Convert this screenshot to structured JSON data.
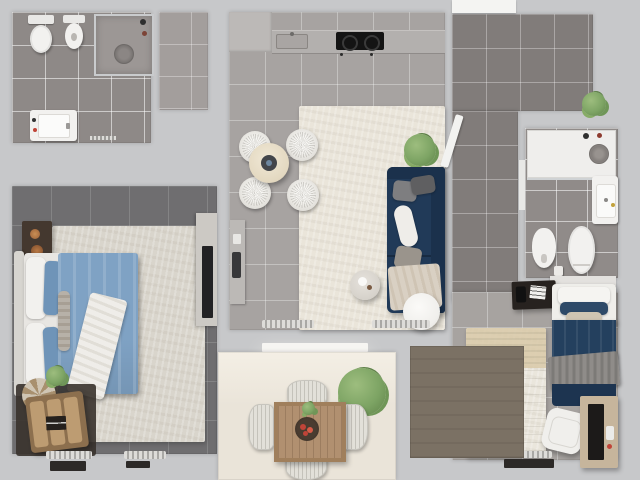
{
  "scene": {
    "title": "Top-down 3D render of an apartment floor plan",
    "rooms": [
      {
        "id": "bathroom-1",
        "label": "Bathroom 1",
        "furniture": [
          "toilet",
          "bidet",
          "shower-cabin",
          "vanity-sink",
          "floor-grille"
        ]
      },
      {
        "id": "entry-hall",
        "label": "Entry Hall",
        "furniture": []
      },
      {
        "id": "kitchen-living-room",
        "label": "Kitchen / Living Room",
        "furniture": [
          "kitchen-counter",
          "kitchen-sink",
          "cooktop",
          "round-dining-table",
          "dining-chair x4",
          "area-rug",
          "corner-sofa",
          "sofa-pillows",
          "throw-blanket",
          "side-table",
          "round-coffee-table",
          "potted-plant",
          "wall-console",
          "radiator x2",
          "balcony-door"
        ]
      },
      {
        "id": "bedroom-1",
        "label": "Bedroom 1 (Master)",
        "furniture": [
          "double-bed",
          "blue-duvet",
          "pillows",
          "knit-throw",
          "nightstand",
          "wardrobe-with-tv",
          "bench",
          "round-pouf",
          "small-plant",
          "area-rug",
          "radiator x2",
          "floor-vent x2"
        ]
      },
      {
        "id": "hallway",
        "label": "Hallway / Corridor",
        "furniture": [
          "open-door",
          "potted-plant",
          "entry-opening"
        ]
      },
      {
        "id": "bathroom-2",
        "label": "Bathroom 2",
        "furniture": [
          "walk-in-shower",
          "shower-head",
          "vanity-sink",
          "bidet",
          "toilet",
          "waste-bin"
        ]
      },
      {
        "id": "bedroom-2",
        "label": "Bedroom 2",
        "furniture": [
          "single-bed",
          "navy-duvet",
          "gray-blanket",
          "nightstand-with-papers",
          "area-rug",
          "desk",
          "shelf-unit",
          "desk-chair",
          "radiator"
        ]
      },
      {
        "id": "balcony",
        "label": "Balcony / Terrace",
        "furniture": [
          "square-wood-table",
          "fruit-bowl",
          "wicker-chair x4",
          "potted-plant",
          "wood-deck"
        ]
      }
    ],
    "palette": {
      "bg": "#c7c8ca",
      "bath-floor": "#8e8987",
      "bath2-floor": "#908b89",
      "entry-floor": "#a39e9c",
      "kitchen-floor": "#a7a3a1",
      "hall-floor": "#817c7a",
      "bed1-floor": "#6f6e70",
      "bed2-floor": "#a7a3a0",
      "balcony-floor": "#eae4d9",
      "deck": "#7b7164",
      "rug1": "#d9d5cc",
      "rug2": "#eae6dc",
      "living-rug": "#eae5da",
      "counter": "#b3b0ae",
      "counter-hi": "#bcb9b7",
      "cooktop": "#141414",
      "fixture-white": "#f2f1ef",
      "door-white": "#f6f5f2",
      "sofa-navy": "#213a58",
      "sofa-navy-dark": "#1b314c",
      "bed-blue": "#7fa2c4",
      "bed-blue-dark": "#6f94b8",
      "bed2-navy": "#24405e",
      "bed2-navy-dark": "#1d3450",
      "blanket-gray": "#8f8c89",
      "mattress": "#e8e6e2",
      "headboard": "#d7d5d0",
      "throw-white": "#efede9",
      "dark-furniture": "#44382f",
      "shelf-dark": "#1c1a19",
      "bench-wood": "#8c6f4e",
      "cushion-tan": "#bd9c72",
      "desk-tan": "#c6b59c",
      "table-wood": "#b19070",
      "table-wood-dark": "#a07f5c",
      "plant-green": "#7da464",
      "shower-gray": "#9c9795",
      "tv-black": "#222224",
      "accent-red": "#c04438",
      "beige-band": "#d9c9a8"
    }
  }
}
